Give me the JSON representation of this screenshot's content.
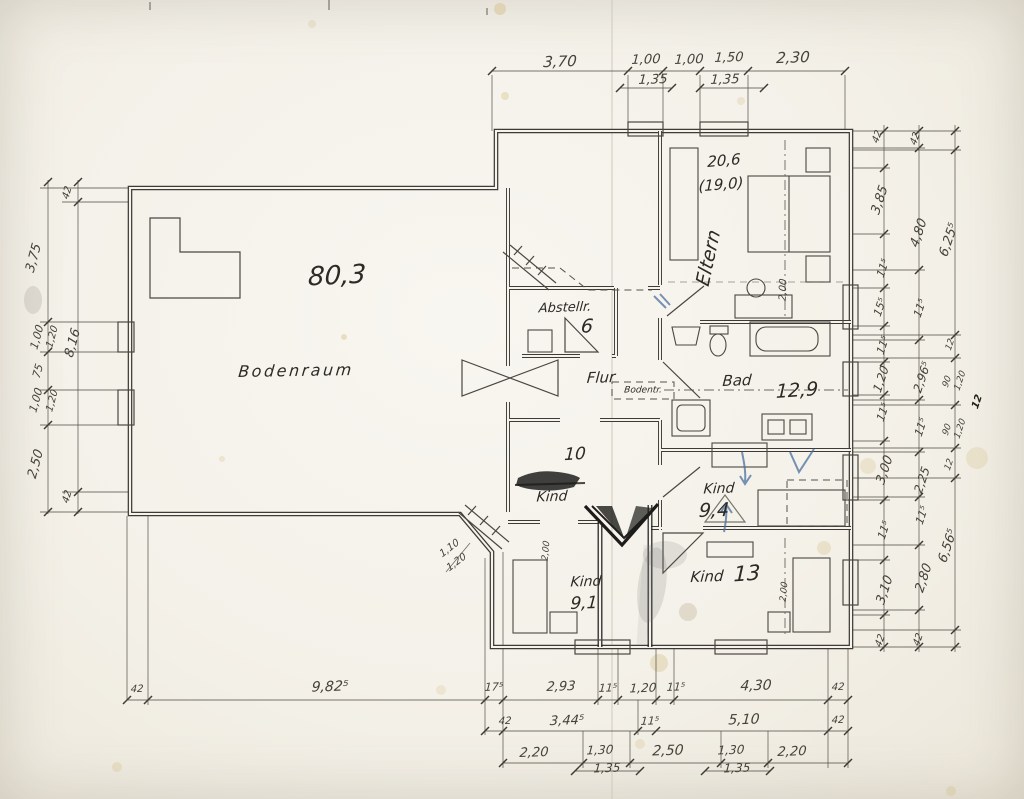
{
  "meta": {
    "description": "Scanned hand-drawn architectural floor plan, attic storey, German room labels",
    "language": "de"
  },
  "colors": {
    "paper": "#f5f2ea",
    "ink": "#3e3b36",
    "pencil": "#8a867e",
    "blue_pen": "#4a6f9e",
    "stain": "#d8c28f"
  },
  "rooms": [
    {
      "label": "Bodenraum",
      "area": "80,3"
    },
    {
      "label": "Abstellr.",
      "area": "6"
    },
    {
      "label": "Flur"
    },
    {
      "label": "Bodentr."
    },
    {
      "label": "Eltern",
      "area": "20,6",
      "area_secondary": "(19,0)"
    },
    {
      "label": "Bad",
      "area": "12,9"
    },
    {
      "label": "Kind",
      "area": "10"
    },
    {
      "label": "Kind",
      "area": "9,4"
    },
    {
      "label": "Kind",
      "area": "9,1"
    },
    {
      "label": "Kind",
      "area": "13"
    }
  ],
  "dimension_chains": {
    "top": [
      "3,70",
      "1,00",
      "1,00",
      "1,50",
      "2,30"
    ],
    "top_alt": [
      "1,35",
      "1,35"
    ],
    "left_outer": [
      "3,75",
      "1,00",
      "75",
      "1,00",
      "2,50"
    ],
    "left_outer_alt": [
      "1,20",
      "1,20"
    ],
    "left_inner": [
      "42",
      "8,16",
      "42"
    ],
    "right_inner": [
      "42",
      "3,85",
      "11⁵",
      "15⁵",
      "11⁵",
      "1,20",
      "11⁵",
      "3,00",
      "11⁵",
      "3,10",
      "42"
    ],
    "right_middle": [
      "42",
      "4,80",
      "11⁵",
      "2,96⁵",
      "11⁵",
      "2,25",
      "11⁵",
      "2,80",
      "42"
    ],
    "right_outer": [
      "6,25⁵",
      "12",
      "90",
      "1,20",
      "90",
      "1,20",
      "12",
      "6,56⁵"
    ],
    "bottom_row1": [
      "42",
      "9,82⁵",
      "17⁵",
      "2,93",
      "11⁵",
      "1,20",
      "11⁵",
      "4,30",
      "42"
    ],
    "bottom_row2": [
      "42",
      "3,44⁵",
      "11⁵",
      "5,10",
      "42"
    ],
    "bottom_row3": [
      "2,20",
      "1,30",
      "2,50",
      "1,30",
      "2,20"
    ],
    "bottom_row3_alt": [
      "1,35",
      "1,35"
    ],
    "diagonal_window": [
      "1,10",
      "1,20"
    ],
    "bed_depths": [
      "2,00",
      "2,00",
      "2,00"
    ]
  },
  "labels": [
    {
      "t": "3,70",
      "x": 560,
      "y": 62,
      "s": 15,
      "r": -2
    },
    {
      "t": "1,00",
      "x": 646,
      "y": 60,
      "s": 13,
      "r": -2
    },
    {
      "t": "1,35",
      "x": 653,
      "y": 80,
      "s": 13,
      "r": -2
    },
    {
      "t": "1,00",
      "x": 689,
      "y": 60,
      "s": 13,
      "r": -2
    },
    {
      "t": "1,50",
      "x": 729,
      "y": 58,
      "s": 13,
      "r": -2
    },
    {
      "t": "1,35",
      "x": 725,
      "y": 80,
      "s": 13,
      "r": -2
    },
    {
      "t": "2,30",
      "x": 793,
      "y": 58,
      "s": 15,
      "r": -2
    },
    {
      "t": "42",
      "x": 878,
      "y": 137,
      "s": 10,
      "r": -72
    },
    {
      "t": "3,85",
      "x": 880,
      "y": 200,
      "s": 13,
      "r": -72
    },
    {
      "t": "11⁵",
      "x": 883,
      "y": 268,
      "s": 11,
      "r": -72
    },
    {
      "t": "15⁵",
      "x": 880,
      "y": 307,
      "s": 11,
      "r": -72
    },
    {
      "t": "11⁵",
      "x": 883,
      "y": 345,
      "s": 11,
      "r": -72
    },
    {
      "t": "1,20",
      "x": 881,
      "y": 379,
      "s": 12,
      "r": -72
    },
    {
      "t": "11⁵",
      "x": 883,
      "y": 412,
      "s": 11,
      "r": -72
    },
    {
      "t": "3,00",
      "x": 885,
      "y": 470,
      "s": 13,
      "r": -72
    },
    {
      "t": "11⁵",
      "x": 884,
      "y": 530,
      "s": 11,
      "r": -72
    },
    {
      "t": "3,10",
      "x": 885,
      "y": 590,
      "s": 13,
      "r": -72
    },
    {
      "t": "42",
      "x": 881,
      "y": 641,
      "s": 10,
      "r": -72
    },
    {
      "t": "42",
      "x": 916,
      "y": 139,
      "s": 10,
      "r": -72
    },
    {
      "t": "4,80",
      "x": 919,
      "y": 233,
      "s": 13,
      "r": -72
    },
    {
      "t": "11⁵",
      "x": 920,
      "y": 308,
      "s": 11,
      "r": -72
    },
    {
      "t": "2,96⁵",
      "x": 922,
      "y": 377,
      "s": 12,
      "r": -72
    },
    {
      "t": "11⁵",
      "x": 921,
      "y": 427,
      "s": 11,
      "r": -72
    },
    {
      "t": "2,25",
      "x": 922,
      "y": 480,
      "s": 12,
      "r": -72
    },
    {
      "t": "11⁵",
      "x": 922,
      "y": 515,
      "s": 11,
      "r": -72
    },
    {
      "t": "2,80",
      "x": 924,
      "y": 578,
      "s": 13,
      "r": -72
    },
    {
      "t": "42",
      "x": 919,
      "y": 640,
      "s": 10,
      "r": -72
    },
    {
      "t": "6,25⁵",
      "x": 949,
      "y": 240,
      "s": 13,
      "r": -72
    },
    {
      "t": "12",
      "x": 951,
      "y": 345,
      "s": 9,
      "r": -72
    },
    {
      "t": "90",
      "x": 948,
      "y": 382,
      "s": 9,
      "r": -72
    },
    {
      "t": "1,20",
      "x": 961,
      "y": 381,
      "s": 9,
      "r": -72
    },
    {
      "t": "90",
      "x": 948,
      "y": 430,
      "s": 9,
      "r": -72
    },
    {
      "t": "1,20",
      "x": 961,
      "y": 429,
      "s": 9,
      "r": -72
    },
    {
      "t": "12",
      "x": 950,
      "y": 465,
      "s": 9,
      "r": -72
    },
    {
      "t": "12",
      "x": 978,
      "y": 402,
      "s": 10,
      "r": -72,
      "cls": "dark"
    },
    {
      "t": "6,56⁵",
      "x": 948,
      "y": 546,
      "s": 13,
      "r": -72
    },
    {
      "t": "42",
      "x": 68,
      "y": 193,
      "s": 10,
      "r": -75
    },
    {
      "t": "3,75",
      "x": 34,
      "y": 258,
      "s": 13,
      "r": -75
    },
    {
      "t": "1,00",
      "x": 37,
      "y": 337,
      "s": 11,
      "r": -75
    },
    {
      "t": "1,20",
      "x": 53,
      "y": 337,
      "s": 10,
      "r": -75
    },
    {
      "t": "75",
      "x": 38,
      "y": 371,
      "s": 11,
      "r": -75
    },
    {
      "t": "1,00",
      "x": 36,
      "y": 400,
      "s": 11,
      "r": -75
    },
    {
      "t": "1,20",
      "x": 53,
      "y": 401,
      "s": 10,
      "r": -75
    },
    {
      "t": "2,50",
      "x": 36,
      "y": 464,
      "s": 13,
      "r": -75
    },
    {
      "t": "8,16",
      "x": 73,
      "y": 343,
      "s": 13,
      "r": -75
    },
    {
      "t": "42",
      "x": 68,
      "y": 497,
      "s": 10,
      "r": -75
    },
    {
      "t": "42",
      "x": 137,
      "y": 690,
      "s": 10,
      "r": -2
    },
    {
      "t": "9,82⁵",
      "x": 330,
      "y": 687,
      "s": 14,
      "r": -2
    },
    {
      "t": "17⁵",
      "x": 494,
      "y": 687,
      "s": 11,
      "r": -2
    },
    {
      "t": "2,93",
      "x": 561,
      "y": 687,
      "s": 13,
      "r": -2
    },
    {
      "t": "11⁵",
      "x": 608,
      "y": 688,
      "s": 11,
      "r": -2
    },
    {
      "t": "1,20",
      "x": 643,
      "y": 688,
      "s": 12,
      "r": -2
    },
    {
      "t": "11⁵",
      "x": 676,
      "y": 687,
      "s": 11,
      "r": -2
    },
    {
      "t": "4,30",
      "x": 756,
      "y": 686,
      "s": 14,
      "r": -2
    },
    {
      "t": "42",
      "x": 838,
      "y": 688,
      "s": 10,
      "r": -2
    },
    {
      "t": "42",
      "x": 505,
      "y": 722,
      "s": 10,
      "r": -2
    },
    {
      "t": "3,44⁵",
      "x": 567,
      "y": 721,
      "s": 13,
      "r": -2
    },
    {
      "t": "11⁵",
      "x": 650,
      "y": 721,
      "s": 11,
      "r": -2
    },
    {
      "t": "5,10",
      "x": 744,
      "y": 720,
      "s": 14,
      "r": -2
    },
    {
      "t": "42",
      "x": 838,
      "y": 721,
      "s": 10,
      "r": -2
    },
    {
      "t": "2,20",
      "x": 534,
      "y": 753,
      "s": 13,
      "r": -2
    },
    {
      "t": "1,30",
      "x": 600,
      "y": 750,
      "s": 12,
      "r": -2
    },
    {
      "t": "1,35",
      "x": 607,
      "y": 768,
      "s": 12,
      "r": -2
    },
    {
      "t": "2,50",
      "x": 668,
      "y": 751,
      "s": 14,
      "r": -2
    },
    {
      "t": "1,30",
      "x": 731,
      "y": 750,
      "s": 12,
      "r": -2
    },
    {
      "t": "1,35",
      "x": 737,
      "y": 768,
      "s": 12,
      "r": -2
    },
    {
      "t": "2,20",
      "x": 792,
      "y": 752,
      "s": 13,
      "r": -2
    },
    {
      "t": "80,3",
      "x": 337,
      "y": 276,
      "s": 26,
      "r": -3,
      "n": "area-bodenraum",
      "cls": "room"
    },
    {
      "t": "Bodenraum",
      "x": 296,
      "y": 371,
      "s": 16,
      "r": -1,
      "n": "room-bodenraum",
      "cls": "room sp"
    },
    {
      "t": "Abstellr.",
      "x": 565,
      "y": 308,
      "s": 13,
      "r": -2,
      "n": "room-abstellraum",
      "cls": "room"
    },
    {
      "t": "6",
      "x": 587,
      "y": 327,
      "s": 19,
      "r": 0,
      "n": "area-abstellraum",
      "cls": "room"
    },
    {
      "t": "Flur",
      "x": 601,
      "y": 378,
      "s": 15,
      "r": -2,
      "n": "room-flur",
      "cls": "room"
    },
    {
      "t": "Bodentr.",
      "x": 643,
      "y": 391,
      "s": 9,
      "r": 0,
      "n": "label-bodentreppe",
      "cls": "room"
    },
    {
      "t": "20,6",
      "x": 724,
      "y": 161,
      "s": 15,
      "r": -5,
      "n": "area-eltern",
      "cls": "room"
    },
    {
      "t": "(19,0)",
      "x": 721,
      "y": 185,
      "s": 15,
      "r": -5,
      "n": "area-eltern-alt",
      "cls": "room"
    },
    {
      "t": "Eltern",
      "x": 709,
      "y": 258,
      "s": 19,
      "r": -78,
      "n": "room-eltern",
      "cls": "room"
    },
    {
      "t": "2,00",
      "x": 784,
      "y": 290,
      "s": 10,
      "r": -88,
      "n": "dim-bed-eltern"
    },
    {
      "t": "Bad",
      "x": 737,
      "y": 381,
      "s": 15,
      "r": -2,
      "n": "room-bad",
      "cls": "room"
    },
    {
      "t": "12,9",
      "x": 797,
      "y": 391,
      "s": 19,
      "r": -4,
      "n": "area-bad",
      "cls": "room"
    },
    {
      "t": "10",
      "x": 575,
      "y": 455,
      "s": 17,
      "r": -3,
      "n": "area-kind-10",
      "cls": "room"
    },
    {
      "t": "Kind",
      "x": 552,
      "y": 497,
      "s": 14,
      "r": -2,
      "n": "room-kind-10",
      "cls": "room"
    },
    {
      "t": "Kind",
      "x": 719,
      "y": 489,
      "s": 14,
      "r": -2,
      "n": "room-kind-94",
      "cls": "room"
    },
    {
      "t": "9,4",
      "x": 714,
      "y": 511,
      "s": 19,
      "r": -2,
      "n": "area-kind-94",
      "cls": "room"
    },
    {
      "t": "Kind",
      "x": 586,
      "y": 582,
      "s": 14,
      "r": -2,
      "n": "room-kind-91",
      "cls": "room"
    },
    {
      "t": "9,1",
      "x": 584,
      "y": 604,
      "s": 17,
      "r": -2,
      "n": "area-kind-91",
      "cls": "room"
    },
    {
      "t": "Kind",
      "x": 707,
      "y": 577,
      "s": 15,
      "r": -2,
      "n": "room-kind-13",
      "cls": "room"
    },
    {
      "t": "13",
      "x": 747,
      "y": 574,
      "s": 21,
      "r": -4,
      "n": "area-kind-13",
      "cls": "room"
    },
    {
      "t": "2,00",
      "x": 547,
      "y": 551,
      "s": 9,
      "r": -85,
      "n": "dim-bed-kind-91"
    },
    {
      "t": "2,00",
      "x": 785,
      "y": 592,
      "s": 9,
      "r": -85,
      "n": "dim-bed-kind-13"
    },
    {
      "t": "1,10",
      "x": 450,
      "y": 549,
      "s": 10,
      "r": -38,
      "n": "dim-diagonal-window"
    },
    {
      "t": "1,20",
      "x": 457,
      "y": 563,
      "s": 10,
      "r": -38,
      "n": "dim-diagonal-window"
    }
  ],
  "guides": {
    "hlines": [
      [
        492,
        71,
        845
      ],
      [
        620,
        88,
        672
      ],
      [
        700,
        88,
        764
      ],
      [
        127,
        700,
        848
      ],
      [
        485,
        731,
        848
      ],
      [
        503,
        763,
        848
      ],
      [
        575,
        771,
        640
      ],
      [
        705,
        771,
        770
      ],
      [
        851,
        131,
        961
      ],
      [
        851,
        647,
        961
      ],
      [
        851,
        168,
        890
      ],
      [
        851,
        234,
        890
      ],
      [
        851,
        288,
        890
      ],
      [
        851,
        326,
        890
      ],
      [
        851,
        362,
        890
      ],
      [
        851,
        395,
        890
      ],
      [
        851,
        441,
        890
      ],
      [
        851,
        500,
        890
      ],
      [
        851,
        560,
        890
      ],
      [
        851,
        615,
        890
      ],
      [
        851,
        148,
        925
      ],
      [
        851,
        270,
        925
      ],
      [
        851,
        340,
        925
      ],
      [
        851,
        400,
        925
      ],
      [
        851,
        452,
        925
      ],
      [
        851,
        497,
        925
      ],
      [
        851,
        545,
        925
      ],
      [
        851,
        610,
        925
      ],
      [
        851,
        150,
        961
      ],
      [
        851,
        335,
        961
      ],
      [
        851,
        358,
        961
      ],
      [
        851,
        405,
        961
      ],
      [
        851,
        448,
        961
      ],
      [
        851,
        478,
        961
      ],
      [
        851,
        630,
        961
      ],
      [
        40,
        188,
        128
      ],
      [
        40,
        322,
        128
      ],
      [
        40,
        352,
        128
      ],
      [
        40,
        390,
        128
      ],
      [
        40,
        425,
        128
      ],
      [
        40,
        512,
        128
      ],
      [
        62,
        202,
        128
      ],
      [
        62,
        492,
        128
      ]
    ],
    "vlines": [
      [
        884,
        125,
        652
      ],
      [
        919,
        125,
        652
      ],
      [
        955,
        125,
        652
      ],
      [
        48,
        180,
        514
      ],
      [
        78,
        180,
        514
      ],
      [
        492,
        75,
        131
      ],
      [
        628,
        75,
        124
      ],
      [
        663,
        75,
        124
      ],
      [
        700,
        75,
        124
      ],
      [
        748,
        75,
        124
      ],
      [
        845,
        75,
        131
      ],
      [
        127,
        516,
        700
      ],
      [
        148,
        516,
        705
      ],
      [
        485,
        558,
        735
      ],
      [
        503,
        552,
        768
      ],
      [
        598,
        647,
        705
      ],
      [
        618,
        647,
        705
      ],
      [
        656,
        647,
        705
      ],
      [
        674,
        647,
        705
      ],
      [
        828,
        647,
        768
      ],
      [
        848,
        647,
        768
      ],
      [
        638,
        700,
        735
      ],
      [
        583,
        731,
        768
      ],
      [
        630,
        731,
        768
      ],
      [
        721,
        731,
        768
      ],
      [
        768,
        731,
        768
      ]
    ],
    "hticks": [
      {
        "y": 71,
        "xs": [
          492,
          628,
          663,
          700,
          748,
          845
        ]
      },
      {
        "y": 88,
        "xs": [
          620,
          672,
          700,
          764
        ]
      },
      {
        "y": 700,
        "xs": [
          127,
          148,
          485,
          503,
          598,
          618,
          656,
          674,
          828,
          848
        ]
      },
      {
        "y": 731,
        "xs": [
          485,
          503,
          638,
          656,
          828,
          848
        ]
      },
      {
        "y": 763,
        "xs": [
          503,
          583,
          630,
          721,
          768,
          848
        ]
      },
      {
        "y": 771,
        "xs": [
          575,
          640,
          705,
          770
        ]
      }
    ],
    "vticks": [
      {
        "x": 884,
        "ys": [
          131,
          168,
          234,
          288,
          326,
          362,
          395,
          441,
          500,
          560,
          615,
          647
        ]
      },
      {
        "x": 919,
        "ys": [
          131,
          148,
          270,
          340,
          400,
          452,
          497,
          545,
          610,
          647
        ]
      },
      {
        "x": 955,
        "ys": [
          131,
          150,
          335,
          358,
          405,
          448,
          478,
          630,
          647
        ]
      },
      {
        "x": 48,
        "ys": [
          182,
          322,
          352,
          390,
          425,
          512
        ]
      },
      {
        "x": 78,
        "ys": [
          182,
          202,
          492,
          512
        ]
      }
    ]
  }
}
